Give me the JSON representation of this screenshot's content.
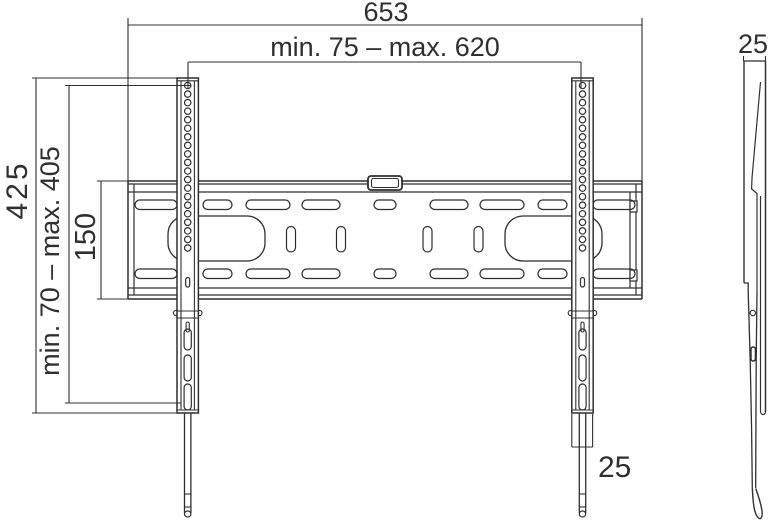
{
  "drawing": {
    "type": "technical-dimension-drawing",
    "subject": "TV wall mount bracket, front view and side profile"
  },
  "front_view": {
    "dim_width_total": "653",
    "dim_width_range": "min. 75 – max. 620",
    "dim_height_total": "425",
    "dim_height_range": "min. 70 – max. 405",
    "dim_plate_height": "150",
    "dim_rail_width": "25"
  },
  "side_view": {
    "dim_depth": "25"
  },
  "colors": {
    "line": "#2f2f2f",
    "background": "#ffffff"
  }
}
